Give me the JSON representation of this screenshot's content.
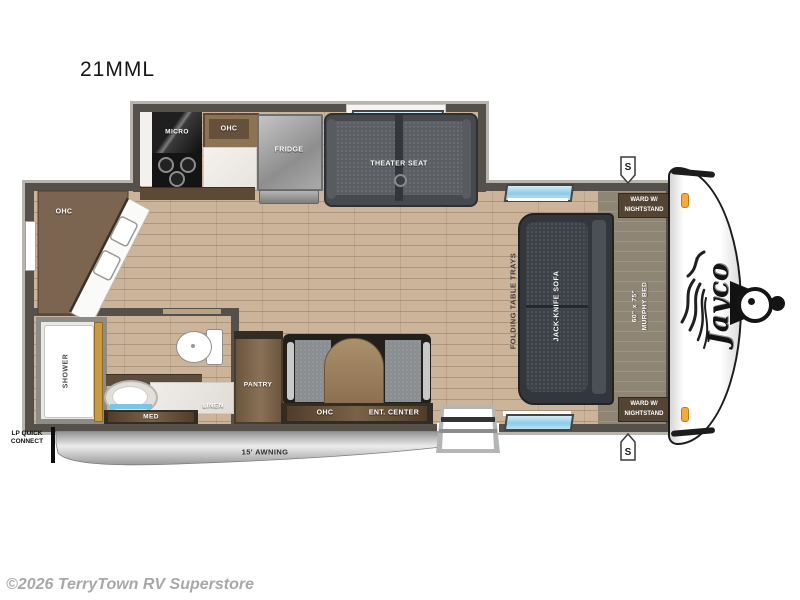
{
  "meta": {
    "title": "21MML",
    "watermark": "©2026 TerryTown RV Superstore"
  },
  "logo": {
    "brand": "Jayco"
  },
  "badges": {
    "speaker": "S"
  },
  "exterior": {
    "awning_label": "15' AWNING",
    "lp_connect_line1": "LP QUICK",
    "lp_connect_line2": "CONNECT"
  },
  "kitchen": {
    "micro": "MICRO",
    "ohc": "OHC",
    "fridge": "FRIDGE",
    "rear_ohc": "OHC"
  },
  "living": {
    "theater_seat": "THEATER SEAT",
    "jack_knife_sofa": "JACK-KNIFE SOFA",
    "folding_table": "FOLDING TABLE TRAYS"
  },
  "bedroom": {
    "murphy_size": "60\" x 75\"",
    "murphy_name": "MURPHY BED",
    "ward_line1": "WARD W/",
    "ward_line2": "NIGHTSTAND"
  },
  "bathroom": {
    "shower": "SHOWER",
    "med": "MED",
    "linen": "LINEN"
  },
  "entry": {
    "pantry": "PANTRY",
    "ohc": "OHC",
    "ent_center": "ENT. CENTER"
  },
  "colors": {
    "floor": "#cbb49a",
    "wall": "#55504a",
    "window": "#8ecbe9",
    "accent_wood": "#7b6450",
    "awning": "#c9c9c9",
    "cap": "#ffffff",
    "marker_light": "#f5a93f"
  }
}
